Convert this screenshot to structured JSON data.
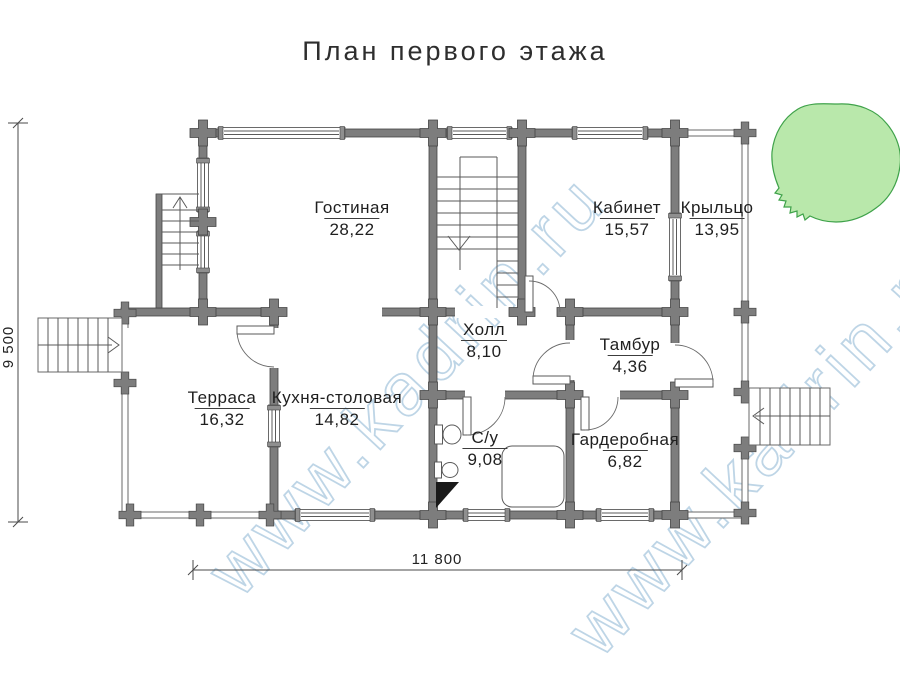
{
  "title": "План первого этажа",
  "watermark": "www.kadrin.ru",
  "rooms": [
    {
      "name": "Гостиная",
      "area": "28,22"
    },
    {
      "name": "Кабинет",
      "area": "15,57"
    },
    {
      "name": "Крыльцо",
      "area": "13,95"
    },
    {
      "name": "Холл",
      "area": "8,10"
    },
    {
      "name": "Тамбур",
      "area": "4,36"
    },
    {
      "name": "Терраса",
      "area": "16,32"
    },
    {
      "name": "Кухня-столовая",
      "area": "14,82"
    },
    {
      "name": "С/у",
      "area": "9,08"
    },
    {
      "name": "Гардеробная",
      "area": "6,82"
    }
  ],
  "dimensions": {
    "height": "9 500",
    "width": "11 800"
  },
  "colors": {
    "wall_gray": "#7d7d7d",
    "watermark_blue": "#aecbe0",
    "tree_fill": "#b9e8ab",
    "tree_stroke": "#3fa24a",
    "text": "#272727"
  }
}
